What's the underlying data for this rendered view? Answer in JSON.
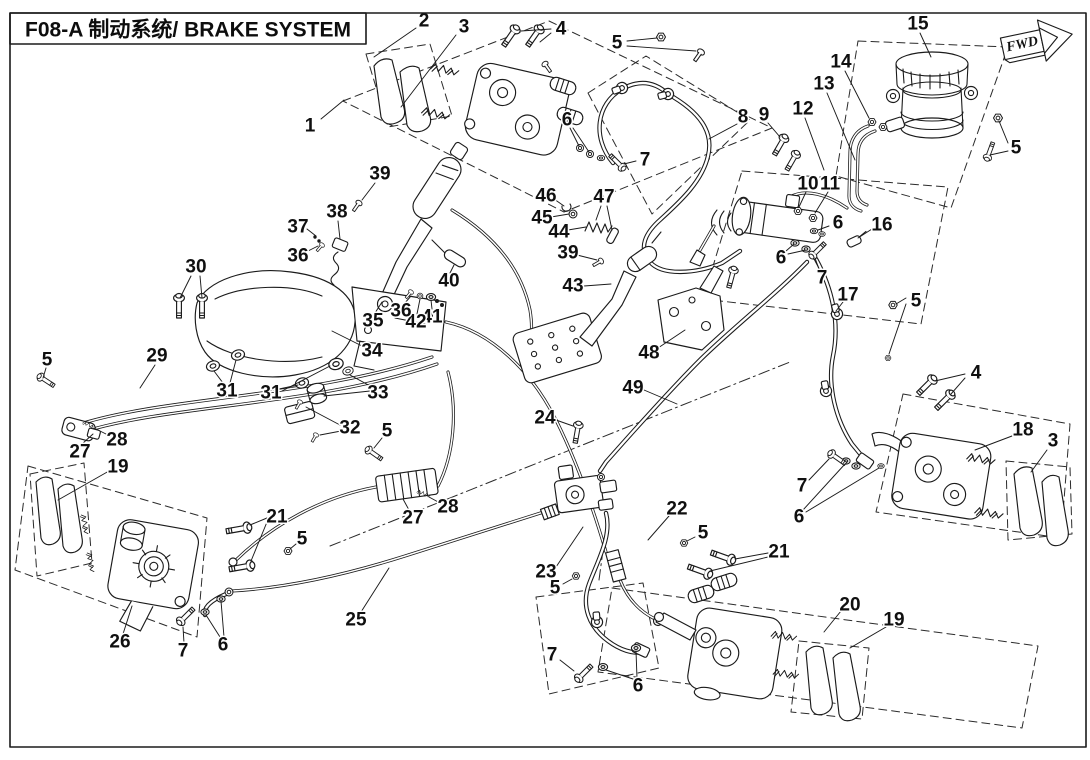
{
  "meta": {
    "title": "F08-A 制动系统/ BRAKE SYSTEM",
    "fwd": "FWD",
    "doc_code": "F08-A",
    "system_name_en": "BRAKE SYSTEM"
  },
  "colors": {
    "ink": "#1b1b1b",
    "background": "#ffffff"
  },
  "callouts": [
    {
      "n": "1",
      "x": 310,
      "y": 126,
      "l": [
        [
          321,
          119,
          344,
          100
        ]
      ]
    },
    {
      "n": "2",
      "x": 424,
      "y": 21,
      "l": [
        [
          416,
          28,
          374,
          57
        ]
      ]
    },
    {
      "n": "3",
      "x": 464,
      "y": 27,
      "l": [
        [
          456,
          35,
          401,
          107
        ]
      ]
    },
    {
      "n": "4",
      "x": 561,
      "y": 29,
      "l": [
        [
          551,
          29,
          521,
          31
        ],
        [
          551,
          33,
          540,
          42
        ]
      ]
    },
    {
      "n": "5",
      "x": 617,
      "y": 43,
      "l": [
        [
          627,
          41,
          657,
          38
        ],
        [
          627,
          46,
          696,
          51
        ]
      ]
    },
    {
      "n": "6",
      "x": 567,
      "y": 120,
      "l": [
        [
          570,
          128,
          579,
          146
        ],
        [
          573,
          128,
          589,
          152
        ]
      ]
    },
    {
      "n": "7",
      "x": 645,
      "y": 160,
      "l": [
        [
          636,
          161,
          624,
          164
        ]
      ]
    },
    {
      "n": "8",
      "x": 743,
      "y": 117,
      "l": [
        [
          737,
          124,
          709,
          139
        ]
      ]
    },
    {
      "n": "9",
      "x": 764,
      "y": 115,
      "l": [
        [
          768,
          123,
          780,
          137
        ]
      ]
    },
    {
      "n": "12",
      "x": 803,
      "y": 109,
      "l": [
        [
          805,
          118,
          824,
          170
        ]
      ]
    },
    {
      "n": "13",
      "x": 824,
      "y": 84,
      "l": [
        [
          827,
          93,
          855,
          160
        ]
      ]
    },
    {
      "n": "14",
      "x": 841,
      "y": 62,
      "l": [
        [
          845,
          71,
          869,
          118
        ]
      ]
    },
    {
      "n": "15",
      "x": 918,
      "y": 24,
      "l": [
        [
          920,
          33,
          931,
          57
        ]
      ]
    },
    {
      "n": "5",
      "x": 1016,
      "y": 148,
      "l": [
        [
          1008,
          143,
          999,
          121
        ],
        [
          1008,
          151,
          990,
          155
        ]
      ]
    },
    {
      "n": "10",
      "x": 808,
      "y": 184,
      "l": [
        [
          806,
          192,
          799,
          207
        ]
      ]
    },
    {
      "n": "11",
      "x": 830,
      "y": 184,
      "l": [
        [
          828,
          192,
          815,
          213
        ]
      ]
    },
    {
      "n": "16",
      "x": 882,
      "y": 225,
      "l": [
        [
          872,
          229,
          858,
          238
        ]
      ]
    },
    {
      "n": "6",
      "x": 838,
      "y": 223,
      "l": [
        [
          829,
          226,
          818,
          230
        ]
      ]
    },
    {
      "n": "6",
      "x": 781,
      "y": 258,
      "l": [
        [
          786,
          251,
          794,
          244
        ],
        [
          788,
          254,
          806,
          250
        ]
      ]
    },
    {
      "n": "7",
      "x": 822,
      "y": 278,
      "l": [
        [
          819,
          269,
          815,
          258
        ]
      ]
    },
    {
      "n": "17",
      "x": 848,
      "y": 295,
      "l": [
        [
          843,
          302,
          836,
          311
        ]
      ]
    },
    {
      "n": "5",
      "x": 916,
      "y": 301,
      "l": [
        [
          906,
          298,
          896,
          304
        ],
        [
          906,
          304,
          889,
          354
        ]
      ]
    },
    {
      "n": "4",
      "x": 976,
      "y": 373,
      "l": [
        [
          965,
          374,
          935,
          381
        ],
        [
          965,
          378,
          951,
          394
        ]
      ]
    },
    {
      "n": "18",
      "x": 1023,
      "y": 430,
      "l": [
        [
          1012,
          436,
          975,
          450
        ]
      ]
    },
    {
      "n": "3",
      "x": 1053,
      "y": 441,
      "l": [
        [
          1047,
          450,
          1031,
          472
        ]
      ]
    },
    {
      "n": "7",
      "x": 802,
      "y": 486,
      "l": [
        [
          809,
          480,
          829,
          459
        ]
      ]
    },
    {
      "n": "6",
      "x": 799,
      "y": 517,
      "l": [
        [
          803,
          510,
          845,
          464
        ],
        [
          806,
          512,
          879,
          468
        ]
      ]
    },
    {
      "n": "46",
      "x": 546,
      "y": 196,
      "l": [
        [
          554,
          199,
          564,
          206
        ]
      ]
    },
    {
      "n": "45",
      "x": 542,
      "y": 218,
      "l": [
        [
          551,
          217,
          569,
          214
        ]
      ]
    },
    {
      "n": "44",
      "x": 559,
      "y": 232,
      "l": [
        [
          568,
          230,
          586,
          227
        ]
      ]
    },
    {
      "n": "47",
      "x": 604,
      "y": 197,
      "l": [
        [
          601,
          206,
          596,
          220
        ],
        [
          607,
          206,
          612,
          230
        ]
      ]
    },
    {
      "n": "39",
      "x": 568,
      "y": 253,
      "l": [
        [
          577,
          255,
          597,
          260
        ]
      ]
    },
    {
      "n": "43",
      "x": 573,
      "y": 286,
      "l": [
        [
          584,
          286,
          611,
          284
        ]
      ]
    },
    {
      "n": "48",
      "x": 649,
      "y": 353,
      "l": [
        [
          658,
          348,
          685,
          330
        ]
      ]
    },
    {
      "n": "49",
      "x": 633,
      "y": 388,
      "l": [
        [
          644,
          390,
          677,
          404
        ]
      ]
    },
    {
      "n": "39",
      "x": 380,
      "y": 174,
      "l": [
        [
          375,
          183,
          362,
          200
        ]
      ]
    },
    {
      "n": "38",
      "x": 337,
      "y": 212,
      "l": [
        [
          338,
          221,
          340,
          239
        ]
      ]
    },
    {
      "n": "37",
      "x": 298,
      "y": 227,
      "l": [
        [
          307,
          229,
          316,
          236
        ]
      ]
    },
    {
      "n": "36",
      "x": 298,
      "y": 256,
      "l": [
        [
          306,
          252,
          318,
          246
        ]
      ]
    },
    {
      "n": "30",
      "x": 196,
      "y": 267,
      "l": [
        [
          191,
          276,
          180,
          298
        ],
        [
          200,
          276,
          202,
          298
        ]
      ]
    },
    {
      "n": "40",
      "x": 449,
      "y": 281,
      "l": [
        [
          450,
          273,
          454,
          265
        ]
      ]
    },
    {
      "n": "41",
      "x": 432,
      "y": 317,
      "l": [
        [
          432,
          309,
          431,
          300
        ]
      ]
    },
    {
      "n": "42",
      "x": 416,
      "y": 322,
      "l": [
        [
          417,
          314,
          420,
          299
        ]
      ]
    },
    {
      "n": "36",
      "x": 401,
      "y": 311,
      "l": [
        [
          404,
          304,
          411,
          296
        ]
      ]
    },
    {
      "n": "35",
      "x": 373,
      "y": 321,
      "l": [
        [
          375,
          313,
          382,
          302
        ]
      ]
    },
    {
      "n": "34",
      "x": 372,
      "y": 351,
      "l": [
        [
          364,
          347,
          332,
          331
        ]
      ]
    },
    {
      "n": "31",
      "x": 227,
      "y": 391,
      "l": [
        [
          223,
          383,
          214,
          371
        ],
        [
          230,
          383,
          236,
          360
        ]
      ]
    },
    {
      "n": "31",
      "x": 271,
      "y": 393,
      "l": [
        [
          279,
          389,
          298,
          385
        ],
        [
          282,
          391,
          330,
          366
        ]
      ]
    },
    {
      "n": "33",
      "x": 378,
      "y": 393,
      "l": [
        [
          370,
          391,
          324,
          396
        ],
        [
          372,
          387,
          350,
          375
        ]
      ]
    },
    {
      "n": "32",
      "x": 350,
      "y": 428,
      "l": [
        [
          340,
          425,
          306,
          407
        ],
        [
          341,
          431,
          320,
          435
        ]
      ]
    },
    {
      "n": "29",
      "x": 157,
      "y": 356,
      "l": [
        [
          155,
          365,
          140,
          388
        ]
      ]
    },
    {
      "n": "5",
      "x": 47,
      "y": 360,
      "l": [
        [
          46,
          368,
          43,
          378
        ]
      ]
    },
    {
      "n": "27",
      "x": 80,
      "y": 452,
      "l": [
        [
          82,
          444,
          93,
          434
        ]
      ]
    },
    {
      "n": "28",
      "x": 117,
      "y": 440,
      "l": [
        [
          110,
          436,
          96,
          429
        ]
      ]
    },
    {
      "n": "19",
      "x": 118,
      "y": 467,
      "l": [
        [
          109,
          471,
          58,
          500
        ]
      ]
    },
    {
      "n": "21",
      "x": 277,
      "y": 517,
      "l": [
        [
          267,
          518,
          250,
          525
        ],
        [
          267,
          522,
          251,
          561
        ]
      ]
    },
    {
      "n": "5",
      "x": 302,
      "y": 539,
      "l": [
        [
          296,
          544,
          290,
          549
        ]
      ]
    },
    {
      "n": "26",
      "x": 120,
      "y": 642,
      "l": [
        [
          123,
          634,
          132,
          606
        ]
      ]
    },
    {
      "n": "7",
      "x": 183,
      "y": 651,
      "l": [
        [
          184,
          643,
          183,
          627
        ]
      ]
    },
    {
      "n": "6",
      "x": 223,
      "y": 645,
      "l": [
        [
          220,
          637,
          206,
          615
        ],
        [
          224,
          637,
          221,
          601
        ]
      ]
    },
    {
      "n": "5",
      "x": 387,
      "y": 431,
      "l": [
        [
          382,
          438,
          374,
          448
        ]
      ]
    },
    {
      "n": "27",
      "x": 413,
      "y": 518,
      "l": [
        [
          409,
          510,
          403,
          499
        ]
      ]
    },
    {
      "n": "28",
      "x": 448,
      "y": 507,
      "l": [
        [
          440,
          503,
          429,
          497
        ]
      ]
    },
    {
      "n": "25",
      "x": 356,
      "y": 620,
      "l": [
        [
          361,
          612,
          389,
          568
        ]
      ]
    },
    {
      "n": "24",
      "x": 545,
      "y": 418,
      "l": [
        [
          556,
          420,
          573,
          426
        ]
      ]
    },
    {
      "n": "23",
      "x": 546,
      "y": 572,
      "l": [
        [
          556,
          567,
          583,
          527
        ]
      ]
    },
    {
      "n": "5",
      "x": 555,
      "y": 588,
      "l": [
        [
          563,
          584,
          572,
          579
        ]
      ]
    },
    {
      "n": "22",
      "x": 677,
      "y": 509,
      "l": [
        [
          669,
          516,
          648,
          540
        ]
      ]
    },
    {
      "n": "5",
      "x": 703,
      "y": 533,
      "l": [
        [
          695,
          537,
          687,
          541
        ]
      ]
    },
    {
      "n": "21",
      "x": 779,
      "y": 552,
      "l": [
        [
          768,
          553,
          735,
          559
        ],
        [
          768,
          557,
          710,
          571
        ]
      ]
    },
    {
      "n": "20",
      "x": 850,
      "y": 605,
      "l": [
        [
          841,
          611,
          824,
          632
        ]
      ]
    },
    {
      "n": "19",
      "x": 894,
      "y": 620,
      "l": [
        [
          886,
          627,
          850,
          648
        ]
      ]
    },
    {
      "n": "7",
      "x": 552,
      "y": 655,
      "l": [
        [
          560,
          660,
          574,
          671
        ]
      ]
    },
    {
      "n": "6",
      "x": 638,
      "y": 686,
      "l": [
        [
          633,
          679,
          606,
          670
        ],
        [
          637,
          678,
          636,
          651
        ]
      ]
    }
  ]
}
